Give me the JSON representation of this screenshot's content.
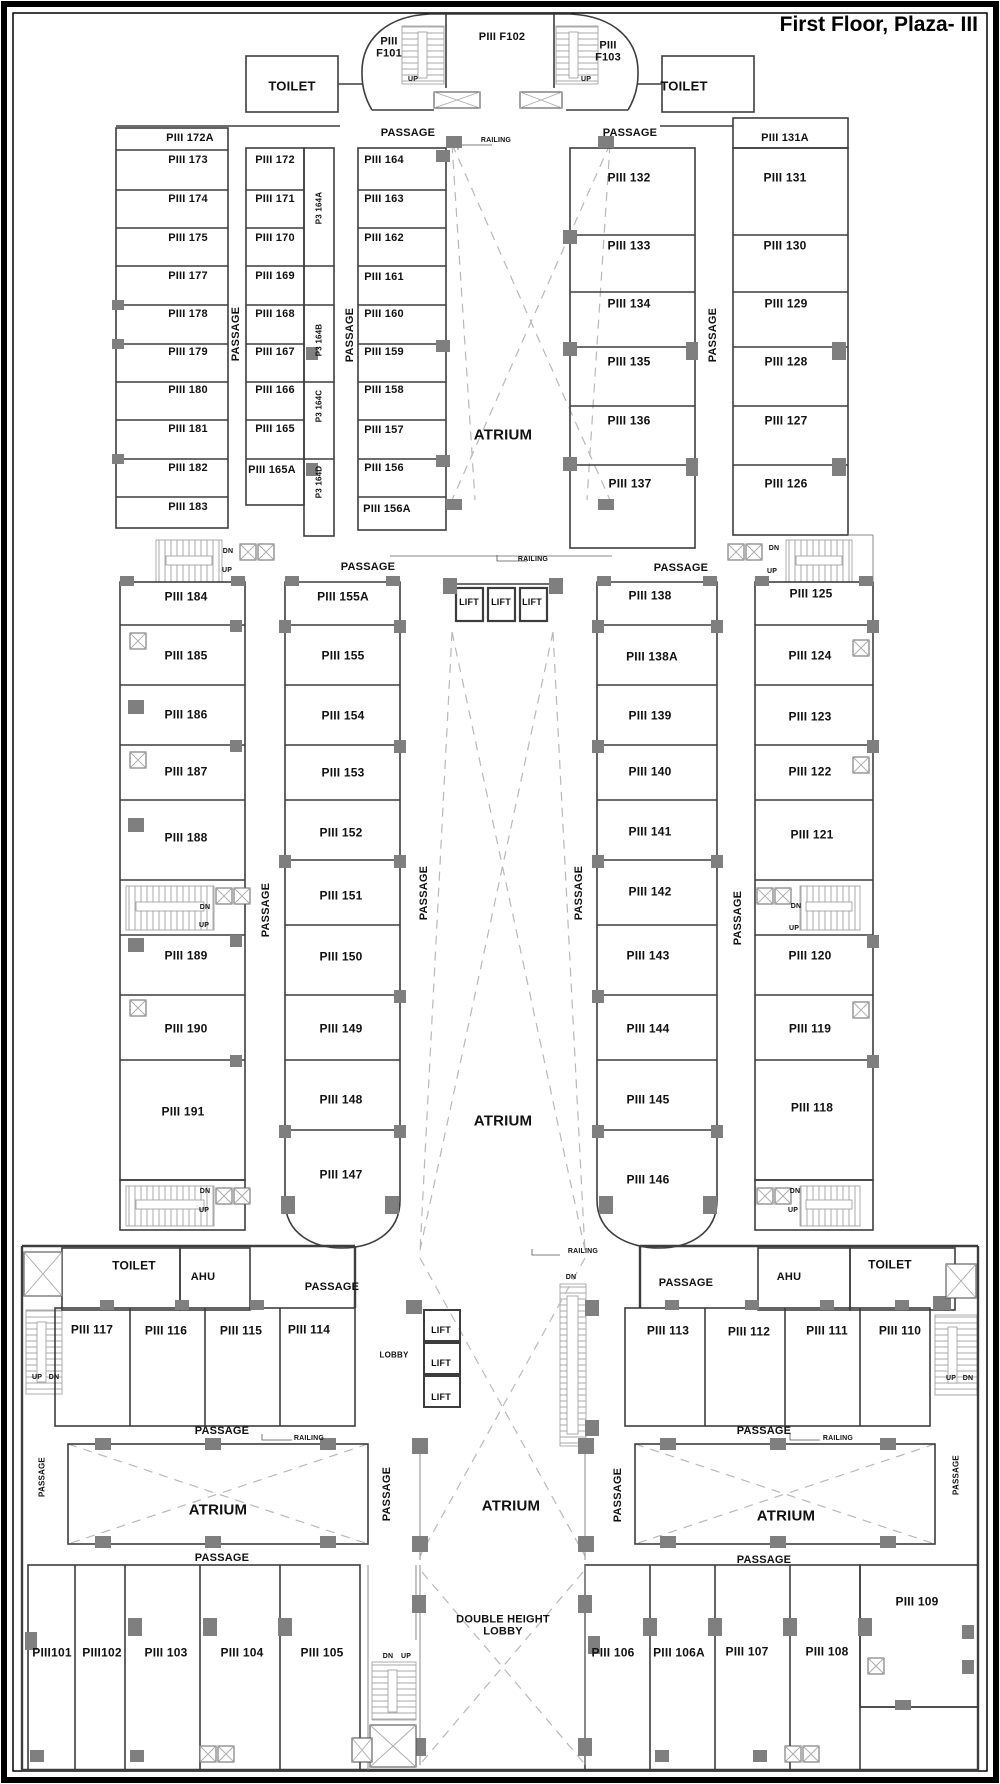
{
  "title": {
    "text": "First Floor, Plaza- III"
  },
  "colors": {
    "background": "#ffffff",
    "line": "#3d3d3d",
    "dash": "#b8b8b8"
  },
  "labels": [
    {
      "n": "room-label-piii-f101",
      "t": "PIII\nF101",
      "x": 389,
      "y": 48,
      "s": 11
    },
    {
      "n": "room-label-piii-f102",
      "t": "PIII F102",
      "x": 502,
      "y": 37,
      "s": 11
    },
    {
      "n": "room-label-piii-f103",
      "t": "PIII\nF103",
      "x": 608,
      "y": 52,
      "s": 11
    },
    {
      "n": "stair-up-label-1",
      "t": "UP",
      "x": 413,
      "y": 80,
      "s": 7
    },
    {
      "n": "stair-up-label-2",
      "t": "UP",
      "x": 586,
      "y": 80,
      "s": 7
    },
    {
      "n": "toilet-label-1",
      "t": "TOILET",
      "x": 292,
      "y": 87,
      "s": 13
    },
    {
      "n": "toilet-label-2",
      "t": "TOILET",
      "x": 684,
      "y": 87,
      "s": 13
    },
    {
      "n": "passage-label-1",
      "t": "PASSAGE",
      "x": 408,
      "y": 133,
      "s": 11
    },
    {
      "n": "passage-label-2",
      "t": "PASSAGE",
      "x": 630,
      "y": 133,
      "s": 11
    },
    {
      "n": "railing-label-1",
      "t": "RAILING",
      "x": 496,
      "y": 141,
      "s": 7
    },
    {
      "n": "room-label-piii-172a",
      "t": "PIII 172A",
      "x": 190,
      "y": 138,
      "s": 11
    },
    {
      "n": "room-label-piii-173",
      "t": "PIII 173",
      "x": 188,
      "y": 160,
      "s": 11
    },
    {
      "n": "room-label-piii-174",
      "t": "PIII 174",
      "x": 188,
      "y": 199,
      "s": 11
    },
    {
      "n": "room-label-piii-175",
      "t": "PIII 175",
      "x": 188,
      "y": 238,
      "s": 11
    },
    {
      "n": "room-label-piii-177",
      "t": "PIII 177",
      "x": 188,
      "y": 276,
      "s": 11
    },
    {
      "n": "room-label-piii-178",
      "t": "PIII 178",
      "x": 188,
      "y": 314,
      "s": 11
    },
    {
      "n": "room-label-piii-179",
      "t": "PIII 179",
      "x": 188,
      "y": 352,
      "s": 11
    },
    {
      "n": "room-label-piii-180",
      "t": "PIII 180",
      "x": 188,
      "y": 390,
      "s": 11
    },
    {
      "n": "room-label-piii-181",
      "t": "PIII 181",
      "x": 188,
      "y": 429,
      "s": 11
    },
    {
      "n": "room-label-piii-182",
      "t": "PIII 182",
      "x": 188,
      "y": 468,
      "s": 11
    },
    {
      "n": "room-label-piii-183",
      "t": "PIII 183",
      "x": 188,
      "y": 507,
      "s": 11
    },
    {
      "n": "passage-label-3",
      "t": "PASSAGE",
      "x": 236,
      "y": 334,
      "s": 11,
      "r": -90
    },
    {
      "n": "room-label-piii-172",
      "t": "PIII 172",
      "x": 275,
      "y": 160,
      "s": 11
    },
    {
      "n": "room-label-piii-171",
      "t": "PIII 171",
      "x": 275,
      "y": 199,
      "s": 11
    },
    {
      "n": "room-label-piii-170",
      "t": "PIII 170",
      "x": 275,
      "y": 238,
      "s": 11
    },
    {
      "n": "room-label-piii-169",
      "t": "PIII 169",
      "x": 275,
      "y": 276,
      "s": 11
    },
    {
      "n": "room-label-piii-168",
      "t": "PIII 168",
      "x": 275,
      "y": 314,
      "s": 11
    },
    {
      "n": "room-label-piii-167",
      "t": "PIII 167",
      "x": 275,
      "y": 352,
      "s": 11
    },
    {
      "n": "room-label-piii-166",
      "t": "PIII 166",
      "x": 275,
      "y": 390,
      "s": 11
    },
    {
      "n": "room-label-piii-165",
      "t": "PIII 165",
      "x": 275,
      "y": 429,
      "s": 11
    },
    {
      "n": "room-label-piii-165a",
      "t": "PIII 165A",
      "x": 272,
      "y": 470,
      "s": 11
    },
    {
      "n": "room-label-p3-164a",
      "t": "P3 164A",
      "x": 320,
      "y": 208,
      "s": 8,
      "r": -90
    },
    {
      "n": "room-label-p3-164b",
      "t": "P3 164B",
      "x": 320,
      "y": 340,
      "s": 8,
      "r": -90
    },
    {
      "n": "room-label-p3-164c",
      "t": "P3 164C",
      "x": 320,
      "y": 406,
      "s": 8,
      "r": -90
    },
    {
      "n": "room-label-p3-164d",
      "t": "P3 164D",
      "x": 320,
      "y": 482,
      "s": 8,
      "r": -90
    },
    {
      "n": "passage-label-4",
      "t": "PASSAGE",
      "x": 350,
      "y": 335,
      "s": 11,
      "r": -90
    },
    {
      "n": "room-label-piii-164",
      "t": "PIII 164",
      "x": 384,
      "y": 160,
      "s": 11
    },
    {
      "n": "room-label-piii-163",
      "t": "PIII 163",
      "x": 384,
      "y": 199,
      "s": 11
    },
    {
      "n": "room-label-piii-162",
      "t": "PIII 162",
      "x": 384,
      "y": 238,
      "s": 11
    },
    {
      "n": "room-label-piii-161",
      "t": "PIII 161",
      "x": 384,
      "y": 277,
      "s": 11
    },
    {
      "n": "room-label-piii-160",
      "t": "PIII 160",
      "x": 384,
      "y": 314,
      "s": 11
    },
    {
      "n": "room-label-piii-159",
      "t": "PIII 159",
      "x": 384,
      "y": 352,
      "s": 11
    },
    {
      "n": "room-label-piii-158",
      "t": "PIII 158",
      "x": 384,
      "y": 390,
      "s": 11
    },
    {
      "n": "room-label-piii-157",
      "t": "PIII 157",
      "x": 384,
      "y": 430,
      "s": 11
    },
    {
      "n": "room-label-piii-156",
      "t": "PIII 156",
      "x": 384,
      "y": 468,
      "s": 11
    },
    {
      "n": "room-label-piii-156a",
      "t": "PIII 156A",
      "x": 387,
      "y": 509,
      "s": 11
    },
    {
      "n": "atrium-label-1",
      "t": "ATRIUM",
      "x": 503,
      "y": 436,
      "s": 15
    },
    {
      "n": "room-label-piii-132",
      "t": "PIII 132",
      "x": 629,
      "y": 178
    },
    {
      "n": "room-label-piii-133",
      "t": "PIII 133",
      "x": 629,
      "y": 246
    },
    {
      "n": "room-label-piii-134",
      "t": "PIII 134",
      "x": 629,
      "y": 304
    },
    {
      "n": "room-label-piii-135",
      "t": "PIII 135",
      "x": 629,
      "y": 362
    },
    {
      "n": "room-label-piii-136",
      "t": "PIII 136",
      "x": 629,
      "y": 421
    },
    {
      "n": "room-label-piii-137",
      "t": "PIII 137",
      "x": 630,
      "y": 484
    },
    {
      "n": "passage-label-5",
      "t": "PASSAGE",
      "x": 713,
      "y": 335,
      "s": 11,
      "r": -90
    },
    {
      "n": "room-label-piii-131a",
      "t": "PIII 131A",
      "x": 785,
      "y": 138,
      "s": 11
    },
    {
      "n": "room-label-piii-131",
      "t": "PIII 131",
      "x": 785,
      "y": 178
    },
    {
      "n": "room-label-piii-130",
      "t": "PIII 130",
      "x": 785,
      "y": 246
    },
    {
      "n": "room-label-piii-129",
      "t": "PIII 129",
      "x": 786,
      "y": 304
    },
    {
      "n": "room-label-piii-128",
      "t": "PIII 128",
      "x": 786,
      "y": 362
    },
    {
      "n": "room-label-piii-127",
      "t": "PIII 127",
      "x": 786,
      "y": 421
    },
    {
      "n": "room-label-piii-126",
      "t": "PIII 126",
      "x": 786,
      "y": 484
    },
    {
      "n": "stair-dn-label-1",
      "t": "DN",
      "x": 228,
      "y": 552,
      "s": 7
    },
    {
      "n": "stair-up-label-3",
      "t": "UP",
      "x": 227,
      "y": 571,
      "s": 7
    },
    {
      "n": "stair-dn-label-2",
      "t": "DN",
      "x": 774,
      "y": 549,
      "s": 7
    },
    {
      "n": "stair-up-label-4",
      "t": "UP",
      "x": 772,
      "y": 572,
      "s": 7
    },
    {
      "n": "passage-label-6",
      "t": "PASSAGE",
      "x": 368,
      "y": 567,
      "s": 11
    },
    {
      "n": "passage-label-7",
      "t": "PASSAGE",
      "x": 681,
      "y": 568,
      "s": 11
    },
    {
      "n": "railing-label-2",
      "t": "RAILING",
      "x": 533,
      "y": 560,
      "s": 7
    },
    {
      "n": "room-label-piii-184",
      "t": "PIII 184",
      "x": 186,
      "y": 597
    },
    {
      "n": "room-label-piii-185",
      "t": "PIII 185",
      "x": 186,
      "y": 656
    },
    {
      "n": "room-label-piii-186",
      "t": "PIII 186",
      "x": 186,
      "y": 715
    },
    {
      "n": "room-label-piii-187",
      "t": "PIII 187",
      "x": 186,
      "y": 772
    },
    {
      "n": "room-label-piii-188",
      "t": "PIII 188",
      "x": 186,
      "y": 838
    },
    {
      "n": "room-label-piii-189",
      "t": "PIII 189",
      "x": 186,
      "y": 956
    },
    {
      "n": "room-label-piii-190",
      "t": "PIII 190",
      "x": 186,
      "y": 1029
    },
    {
      "n": "room-label-piii-191",
      "t": "PIII 191",
      "x": 183,
      "y": 1112
    },
    {
      "n": "stair-dn-label-3",
      "t": "DN",
      "x": 205,
      "y": 908,
      "s": 7
    },
    {
      "n": "stair-up-label-5",
      "t": "UP",
      "x": 204,
      "y": 926,
      "s": 7
    },
    {
      "n": "stair-dn-label-4",
      "t": "DN",
      "x": 205,
      "y": 1192,
      "s": 7
    },
    {
      "n": "stair-up-label-6",
      "t": "UP",
      "x": 204,
      "y": 1211,
      "s": 7
    },
    {
      "n": "passage-label-8",
      "t": "PASSAGE",
      "x": 266,
      "y": 910,
      "s": 11,
      "r": -90
    },
    {
      "n": "room-label-piii-155a",
      "t": "PIII 155A",
      "x": 343,
      "y": 597
    },
    {
      "n": "room-label-piii-155",
      "t": "PIII 155",
      "x": 343,
      "y": 656
    },
    {
      "n": "room-label-piii-154",
      "t": "PIII 154",
      "x": 343,
      "y": 716
    },
    {
      "n": "room-label-piii-153",
      "t": "PIII 153",
      "x": 343,
      "y": 773
    },
    {
      "n": "room-label-piii-152",
      "t": "PIII 152",
      "x": 341,
      "y": 833
    },
    {
      "n": "room-label-piii-151",
      "t": "PIII 151",
      "x": 341,
      "y": 896
    },
    {
      "n": "room-label-piii-150",
      "t": "PIII 150",
      "x": 341,
      "y": 957
    },
    {
      "n": "room-label-piii-149",
      "t": "PIII 149",
      "x": 341,
      "y": 1029
    },
    {
      "n": "room-label-piii-148",
      "t": "PIII 148",
      "x": 341,
      "y": 1100
    },
    {
      "n": "room-label-piii-147",
      "t": "PIII 147",
      "x": 341,
      "y": 1175
    },
    {
      "n": "passage-label-9",
      "t": "PASSAGE",
      "x": 424,
      "y": 893,
      "s": 11,
      "r": -90
    },
    {
      "n": "lift-label-1",
      "t": "LIFT",
      "x": 469,
      "y": 602,
      "s": 9
    },
    {
      "n": "lift-label-2",
      "t": "LIFT",
      "x": 501,
      "y": 602,
      "s": 9
    },
    {
      "n": "lift-label-3",
      "t": "LIFT",
      "x": 532,
      "y": 602,
      "s": 9
    },
    {
      "n": "atrium-label-2",
      "t": "ATRIUM",
      "x": 503,
      "y": 1122,
      "s": 15
    },
    {
      "n": "passage-label-10",
      "t": "PASSAGE",
      "x": 579,
      "y": 893,
      "s": 11,
      "r": -90
    },
    {
      "n": "room-label-piii-138",
      "t": "PIII 138",
      "x": 650,
      "y": 596
    },
    {
      "n": "room-label-piii-138a",
      "t": "PIII 138A",
      "x": 652,
      "y": 657
    },
    {
      "n": "room-label-piii-139",
      "t": "PIII 139",
      "x": 650,
      "y": 716
    },
    {
      "n": "room-label-piii-140",
      "t": "PIII 140",
      "x": 650,
      "y": 772
    },
    {
      "n": "room-label-piii-141",
      "t": "PIII 141",
      "x": 650,
      "y": 832
    },
    {
      "n": "room-label-piii-142",
      "t": "PIII 142",
      "x": 650,
      "y": 892
    },
    {
      "n": "room-label-piii-143",
      "t": "PIII 143",
      "x": 648,
      "y": 956
    },
    {
      "n": "room-label-piii-144",
      "t": "PIII 144",
      "x": 648,
      "y": 1029
    },
    {
      "n": "room-label-piii-145",
      "t": "PIII 145",
      "x": 648,
      "y": 1100
    },
    {
      "n": "room-label-piii-146",
      "t": "PIII 146",
      "x": 648,
      "y": 1180
    },
    {
      "n": "passage-label-11",
      "t": "PASSAGE",
      "x": 738,
      "y": 918,
      "s": 11,
      "r": -90
    },
    {
      "n": "room-label-piii-125",
      "t": "PIII 125",
      "x": 811,
      "y": 594
    },
    {
      "n": "room-label-piii-124",
      "t": "PIII 124",
      "x": 810,
      "y": 656
    },
    {
      "n": "room-label-piii-123",
      "t": "PIII 123",
      "x": 810,
      "y": 717
    },
    {
      "n": "room-label-piii-122",
      "t": "PIII 122",
      "x": 810,
      "y": 772
    },
    {
      "n": "room-label-piii-121",
      "t": "PIII 121",
      "x": 812,
      "y": 835
    },
    {
      "n": "room-label-piii-120",
      "t": "PIII 120",
      "x": 810,
      "y": 956
    },
    {
      "n": "room-label-piii-119",
      "t": "PIII 119",
      "x": 810,
      "y": 1029
    },
    {
      "n": "room-label-piii-118",
      "t": "PIII 118",
      "x": 812,
      "y": 1108
    },
    {
      "n": "stair-dn-label-5",
      "t": "DN",
      "x": 796,
      "y": 907,
      "s": 7
    },
    {
      "n": "stair-up-label-7",
      "t": "UP",
      "x": 794,
      "y": 929,
      "s": 7
    },
    {
      "n": "stair-dn-label-6",
      "t": "DN",
      "x": 795,
      "y": 1192,
      "s": 7
    },
    {
      "n": "stair-up-label-8",
      "t": "UP",
      "x": 793,
      "y": 1211,
      "s": 7
    },
    {
      "n": "railing-label-3",
      "t": "RAILING",
      "x": 583,
      "y": 1252,
      "s": 7
    },
    {
      "n": "toilet-label-3",
      "t": "TOILET",
      "x": 134,
      "y": 1266
    },
    {
      "n": "ahu-label-1",
      "t": "AHU",
      "x": 203,
      "y": 1277,
      "s": 11
    },
    {
      "n": "passage-label-12",
      "t": "PASSAGE",
      "x": 332,
      "y": 1287,
      "s": 11
    },
    {
      "n": "room-label-piii-117",
      "t": "PIII 117",
      "x": 92,
      "y": 1330
    },
    {
      "n": "room-label-piii-116",
      "t": "PIII 116",
      "x": 166,
      "y": 1331
    },
    {
      "n": "room-label-piii-115",
      "t": "PIII 115",
      "x": 241,
      "y": 1331
    },
    {
      "n": "room-label-piii-114",
      "t": "PIII 114",
      "x": 309,
      "y": 1330
    },
    {
      "n": "lobby-label",
      "t": "LOBBY",
      "x": 394,
      "y": 1356,
      "s": 8
    },
    {
      "n": "lift-label-4",
      "t": "LIFT",
      "x": 441,
      "y": 1330,
      "s": 9
    },
    {
      "n": "lift-label-5",
      "t": "LIFT",
      "x": 441,
      "y": 1363,
      "s": 9
    },
    {
      "n": "lift-label-6",
      "t": "LIFT",
      "x": 441,
      "y": 1397,
      "s": 9
    },
    {
      "n": "stair-dn-label-7",
      "t": "DN",
      "x": 571,
      "y": 1278,
      "s": 7
    },
    {
      "n": "passage-label-13",
      "t": "PASSAGE",
      "x": 686,
      "y": 1283,
      "s": 11
    },
    {
      "n": "ahu-label-2",
      "t": "AHU",
      "x": 789,
      "y": 1277,
      "s": 11
    },
    {
      "n": "toilet-label-4",
      "t": "TOILET",
      "x": 890,
      "y": 1265
    },
    {
      "n": "room-label-piii-113",
      "t": "PIII 113",
      "x": 668,
      "y": 1331
    },
    {
      "n": "room-label-piii-112",
      "t": "PIII 112",
      "x": 749,
      "y": 1332
    },
    {
      "n": "room-label-piii-111",
      "t": "PIII 111",
      "x": 827,
      "y": 1331
    },
    {
      "n": "room-label-piii-110",
      "t": "PIII 110",
      "x": 900,
      "y": 1331
    },
    {
      "n": "stair-up-label-9",
      "t": "UP",
      "x": 37,
      "y": 1378,
      "s": 7
    },
    {
      "n": "stair-dn-label-8",
      "t": "DN",
      "x": 54,
      "y": 1378,
      "s": 7
    },
    {
      "n": "stair-up-label-10",
      "t": "UP",
      "x": 951,
      "y": 1379,
      "s": 7
    },
    {
      "n": "stair-dn-label-9",
      "t": "DN",
      "x": 968,
      "y": 1379,
      "s": 7
    },
    {
      "n": "passage-label-14",
      "t": "PASSAGE",
      "x": 222,
      "y": 1431,
      "s": 11
    },
    {
      "n": "railing-label-4",
      "t": "RAILING",
      "x": 309,
      "y": 1439,
      "s": 7
    },
    {
      "n": "passage-label-15",
      "t": "PASSAGE",
      "x": 764,
      "y": 1431,
      "s": 11
    },
    {
      "n": "railing-label-5",
      "t": "RAILING",
      "x": 838,
      "y": 1439,
      "s": 7
    },
    {
      "n": "passage-label-16",
      "t": "PASSAGE",
      "x": 43,
      "y": 1477,
      "s": 8,
      "r": -90
    },
    {
      "n": "atrium-label-3",
      "t": "ATRIUM",
      "x": 218,
      "y": 1511,
      "s": 15
    },
    {
      "n": "passage-label-17",
      "t": "PASSAGE",
      "x": 387,
      "y": 1494,
      "s": 11,
      "r": -90
    },
    {
      "n": "atrium-label-4",
      "t": "ATRIUM",
      "x": 511,
      "y": 1507,
      "s": 15
    },
    {
      "n": "passage-label-18",
      "t": "PASSAGE",
      "x": 618,
      "y": 1495,
      "s": 11,
      "r": -90
    },
    {
      "n": "atrium-label-5",
      "t": "ATRIUM",
      "x": 786,
      "y": 1517,
      "s": 15
    },
    {
      "n": "passage-label-19",
      "t": "PASSAGE",
      "x": 957,
      "y": 1475,
      "s": 8,
      "r": -90
    },
    {
      "n": "passage-label-20",
      "t": "PASSAGE",
      "x": 222,
      "y": 1558,
      "s": 11
    },
    {
      "n": "passage-label-21",
      "t": "PASSAGE",
      "x": 764,
      "y": 1560,
      "s": 11
    },
    {
      "n": "room-label-piii101",
      "t": "PIII101",
      "x": 52,
      "y": 1653
    },
    {
      "n": "room-label-piii102",
      "t": "PIII102",
      "x": 102,
      "y": 1653
    },
    {
      "n": "room-label-piii-103",
      "t": "PIII 103",
      "x": 166,
      "y": 1653
    },
    {
      "n": "room-label-piii-104",
      "t": "PIII 104",
      "x": 242,
      "y": 1653
    },
    {
      "n": "room-label-piii-105",
      "t": "PIII 105",
      "x": 322,
      "y": 1653
    },
    {
      "n": "double-height-lobby-label",
      "t": "DOUBLE HEIGHT\nLOBBY",
      "x": 503,
      "y": 1626,
      "s": 11
    },
    {
      "n": "stair-dn-label-10",
      "t": "DN",
      "x": 388,
      "y": 1657,
      "s": 7
    },
    {
      "n": "stair-up-label-11",
      "t": "UP",
      "x": 406,
      "y": 1657,
      "s": 7
    },
    {
      "n": "room-label-piii-106",
      "t": "PIII 106",
      "x": 613,
      "y": 1653
    },
    {
      "n": "room-label-piii-106a",
      "t": "PIII 106A",
      "x": 679,
      "y": 1653
    },
    {
      "n": "room-label-piii-107",
      "t": "PIII 107",
      "x": 747,
      "y": 1652
    },
    {
      "n": "room-label-piii-108",
      "t": "PIII 108",
      "x": 827,
      "y": 1652
    },
    {
      "n": "room-label-piii-109",
      "t": "PIII 109",
      "x": 917,
      "y": 1602
    }
  ]
}
